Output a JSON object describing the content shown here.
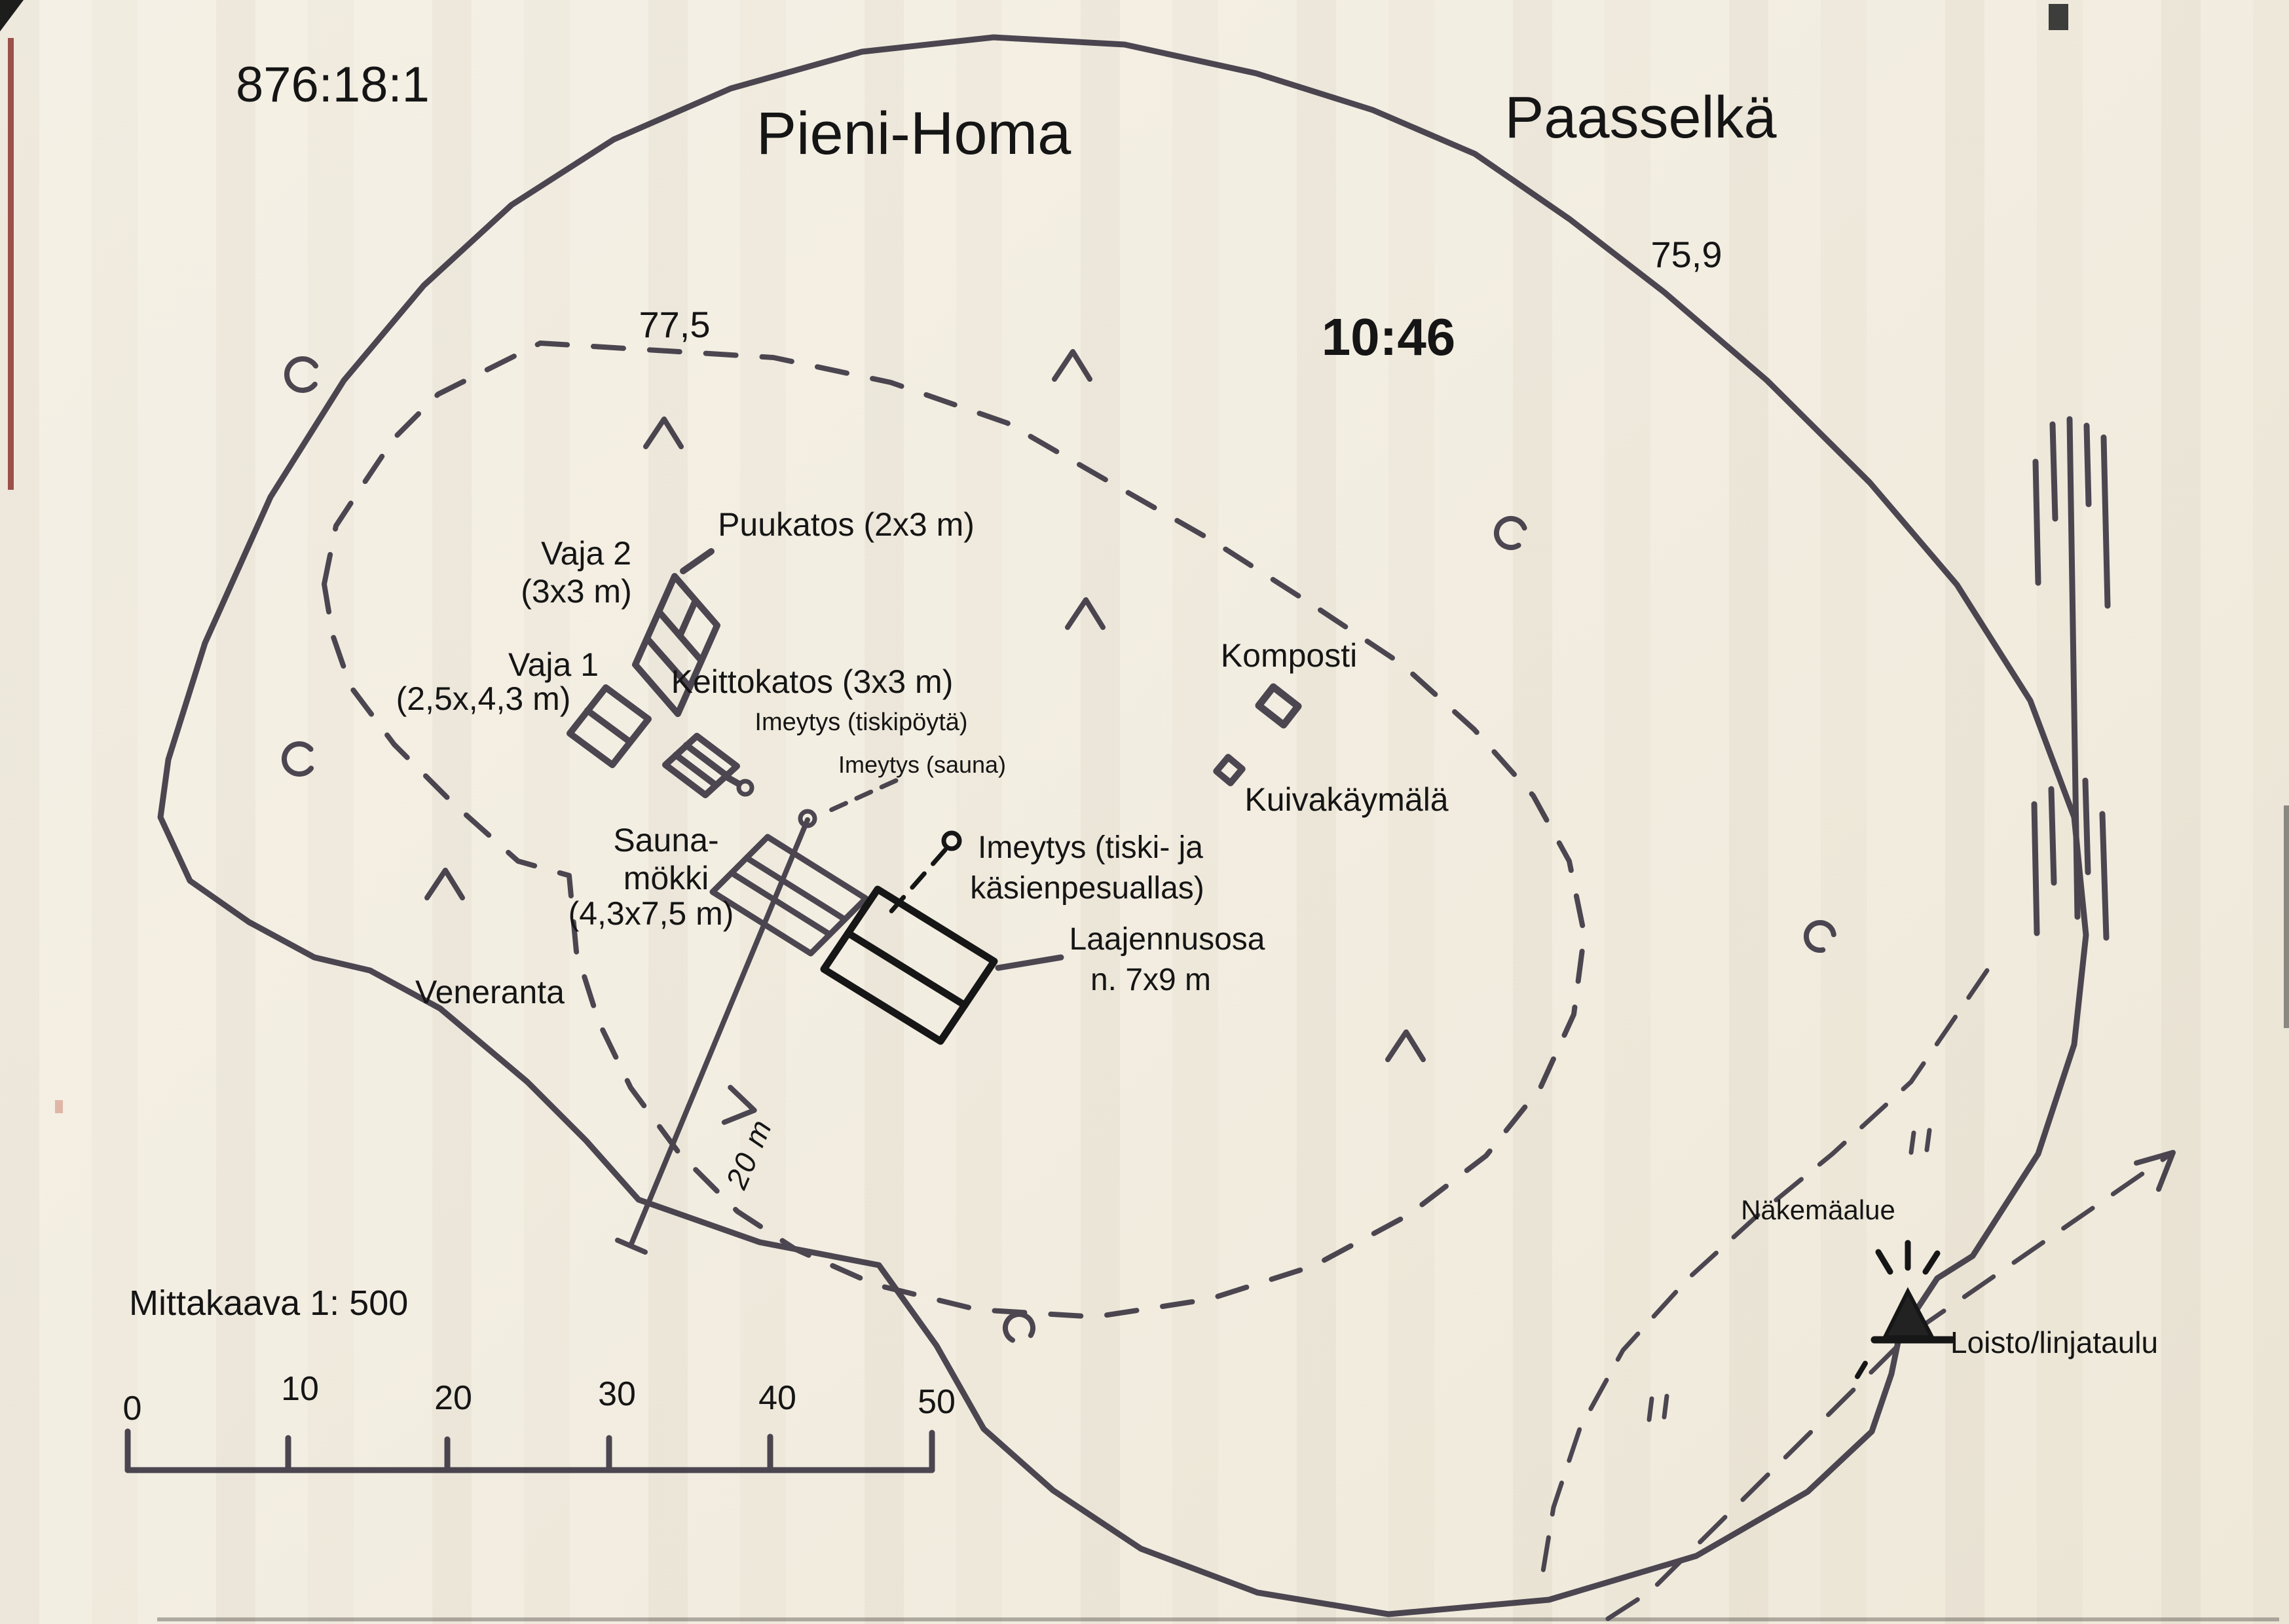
{
  "map": {
    "parcel_id": "876:18:1",
    "island_name": "Pieni-Homa",
    "lake_name": "Paasselkä",
    "lake_elevation": "75,9",
    "time": "10:46",
    "contour_elevation": "77,5",
    "labels": {
      "puukatos": "Puukatos (2x3 m)",
      "vaja2_line1": "Vaja 2",
      "vaja2_line2": "(3x3 m)",
      "vaja1_line1": "Vaja 1",
      "vaja1_line2": "(2,5x,4,3 m)",
      "keittokatos": "Keittokatos (3x3 m)",
      "imeytys_tiskipoyta": "Imeytys (tiskipöytä)",
      "imeytys_sauna": "Imeytys (sauna)",
      "sauna_line1": "Sauna-",
      "sauna_line2": "mökki",
      "sauna_line3": "(4,3x7,5 m)",
      "imeytys_tiski_line1": "Imeytys (tiski- ja",
      "imeytys_tiski_line2": "käsienpesuallas)",
      "laajennus_line1": "Laajennusosa",
      "laajennus_line2": "n. 7x9 m",
      "komposti": "Komposti",
      "kuivakaymala": "Kuivakäymälä",
      "veneranta": "Veneranta",
      "distance_20m": "20 m",
      "nakemaalue": "Näkemäalue",
      "loisto": "Loisto/linjataulu"
    },
    "scale": {
      "caption": "Mittakaava 1: 500",
      "ticks": [
        "0",
        "10",
        "20",
        "30",
        "40",
        "50"
      ]
    },
    "colors": {
      "ink": "#4b4650",
      "building_dark": "#161616",
      "text": "#151515",
      "paper": "#f3eee2",
      "scan_red": "#8b2b25"
    }
  }
}
